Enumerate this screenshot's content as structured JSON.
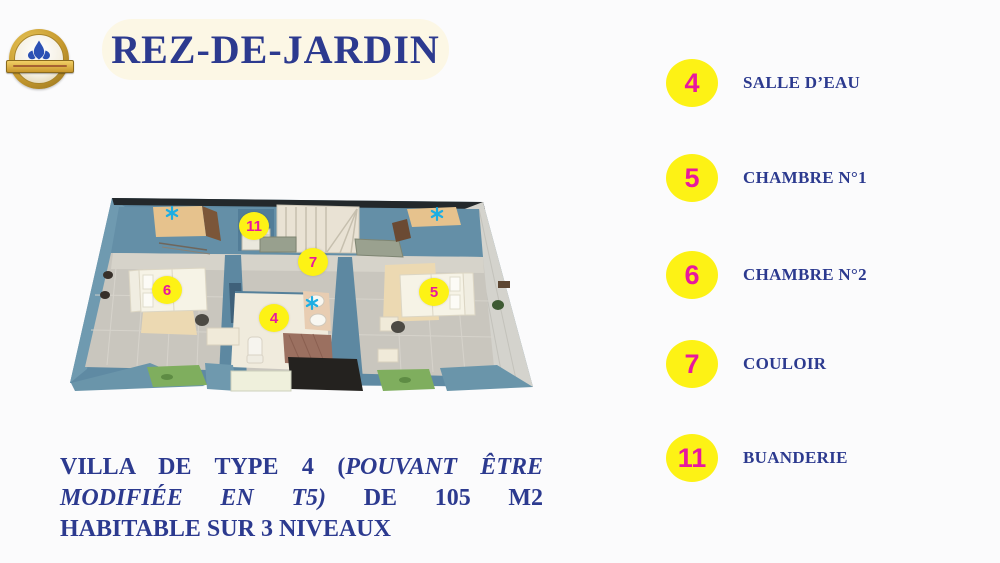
{
  "page": {
    "background": "#fbfbfc"
  },
  "logo": {
    "icon": "fleur-de-lis-badge-icon"
  },
  "header": {
    "title": "REZ-DE-JARDIN"
  },
  "legend": {
    "badge_color": "#fdf215",
    "number_color": "#e8189e",
    "label_color": "#2c3a8f",
    "items": [
      {
        "number": "4",
        "label": "SALLE D’EAU"
      },
      {
        "number": "5",
        "label": "CHAMBRE N°1"
      },
      {
        "number": "6",
        "label": "CHAMBRE N°2"
      },
      {
        "number": "7",
        "label": "COULOIR"
      },
      {
        "number": "11",
        "label": "BUANDERIE"
      }
    ]
  },
  "floor_plan": {
    "marker_color": "#fdf215",
    "marker_number_color": "#e8189e",
    "star_color": "#1daee3",
    "markers": [
      {
        "label": "11",
        "x": 254,
        "y": 226
      },
      {
        "label": "7",
        "x": 313,
        "y": 262
      },
      {
        "label": "6",
        "x": 167,
        "y": 290
      },
      {
        "label": "4",
        "x": 274,
        "y": 318
      },
      {
        "label": "5",
        "x": 434,
        "y": 292
      }
    ],
    "stars": [
      {
        "x": 172,
        "y": 213
      },
      {
        "x": 437,
        "y": 214
      },
      {
        "x": 312,
        "y": 303
      }
    ]
  },
  "caption": {
    "line1_regular": "VILLA DE TYPE 4 (",
    "line1_italic": "POUVANT ÊTRE",
    "line2_italic": "MODIFIÉE EN T5)",
    "line2_regular": "DE 105 M2",
    "line3": "HABITABLE SUR 3 NIVEAUX"
  }
}
